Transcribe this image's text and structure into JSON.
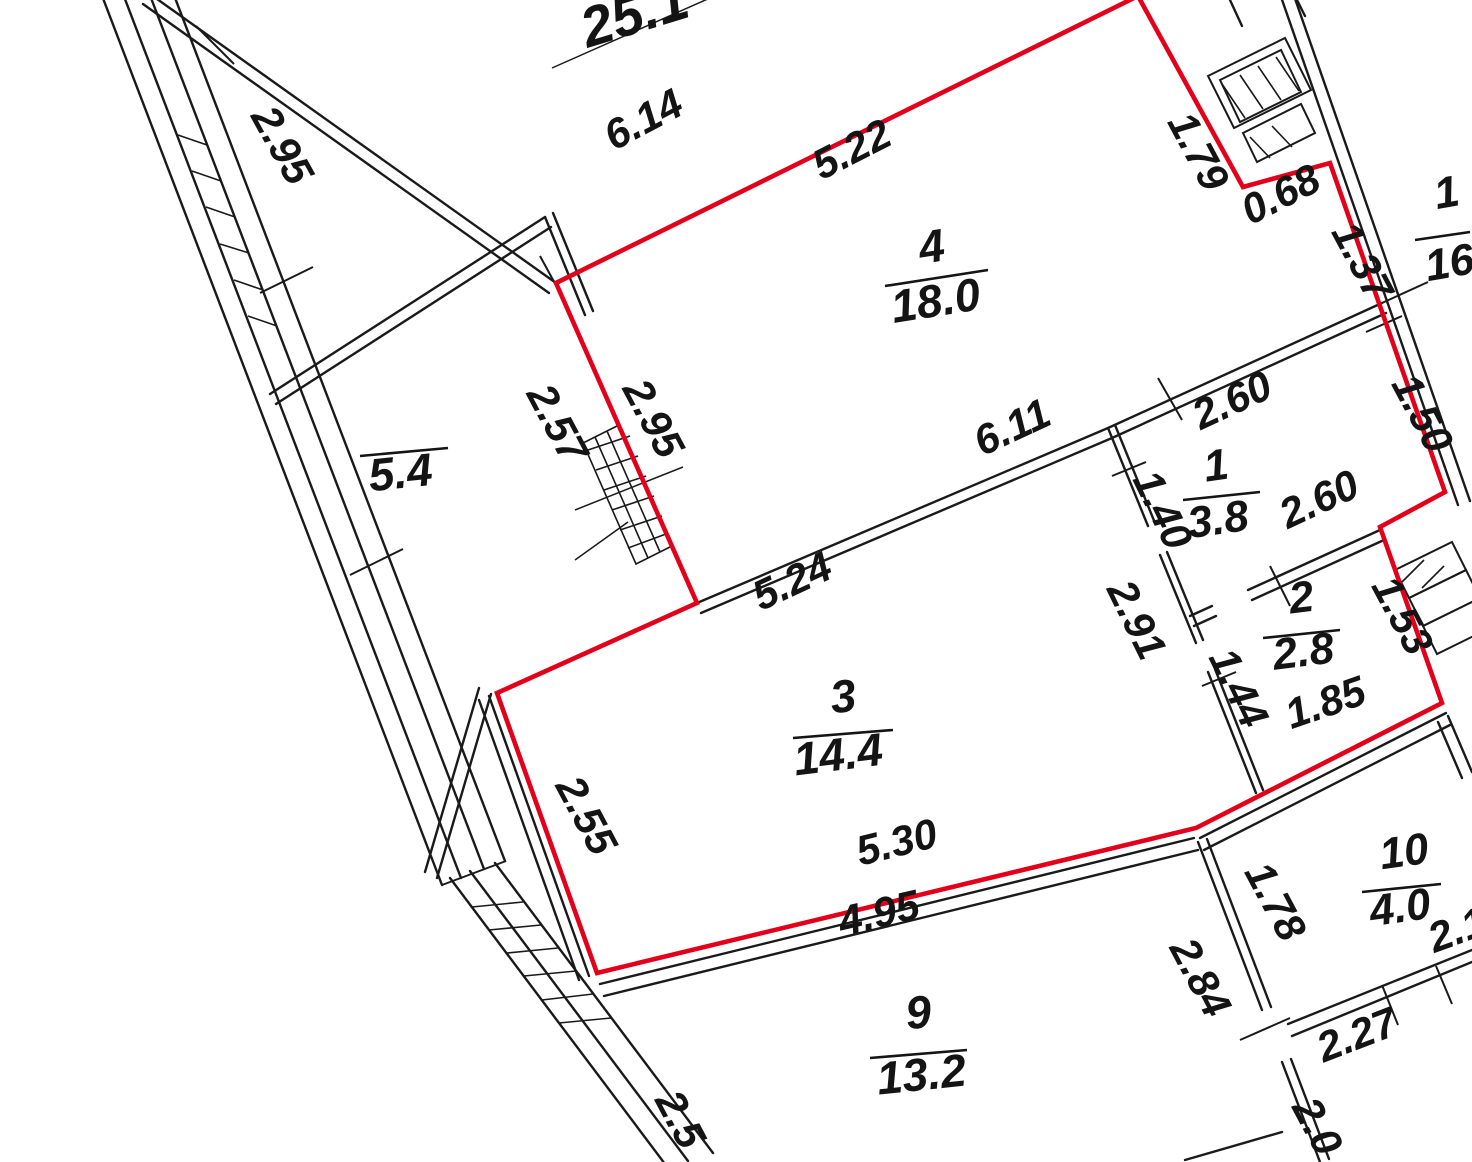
{
  "plan": {
    "highlight_color": "#e3001a",
    "line_color": "#1a1a1a",
    "rooms": {
      "r4": {
        "number": "4",
        "area": "18.0"
      },
      "r1": {
        "number": "1",
        "area": "3.8"
      },
      "r2": {
        "number": "2",
        "area": "2.8"
      },
      "r3": {
        "number": "3",
        "area": "14.4"
      },
      "r9": {
        "number": "9",
        "area": "13.2"
      },
      "r10": {
        "number": "10",
        "area": "4.0"
      },
      "r16": {
        "number": "1",
        "area": "16"
      },
      "balcony": {
        "area": "5.4"
      },
      "neighbor_top": {
        "area": "25.1"
      }
    },
    "dims": {
      "d614": "6.14",
      "d522": "5.22",
      "d179": "1.79",
      "d068": "0.68",
      "d137": "1.37",
      "d295a": "2.95",
      "d257": "2.57",
      "d295b": "2.95",
      "d260a": "2.60",
      "d150": "1.50",
      "d611": "6.11",
      "d140": "1.40",
      "d260b": "2.60",
      "d291": "2.91",
      "d144": "1.44",
      "d153": "1.53",
      "d185": "1.85",
      "d524": "5.24",
      "d255": "2.55",
      "d530": "5.30",
      "d495": "4.95",
      "d178": "1.78",
      "d284": "2.84",
      "d21": "2.1",
      "d227": "2.27",
      "d20": "2.0",
      "d25": "2.5"
    }
  }
}
